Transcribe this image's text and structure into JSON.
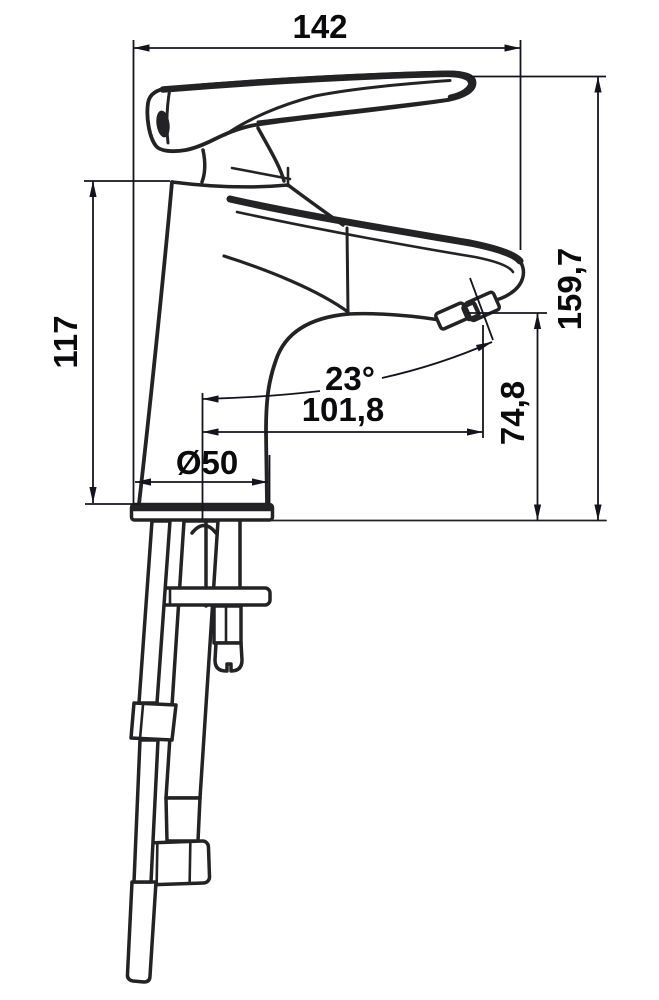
{
  "figure": {
    "type": "technical dimension drawing",
    "subject": "single-lever basin mixer faucet, side view with mounting hardware"
  },
  "labels": {
    "top_width": "142",
    "total_height": "159,7",
    "body_height": "117",
    "outlet_height": "74,8",
    "spout_reach": "101,8",
    "spout_angle": "23°",
    "base_diameter": "Ø50"
  },
  "colors": {
    "drawing_line": "#232326",
    "dimension_line": "#14141f",
    "text": "#0b0b0e",
    "background": "#ffffff"
  }
}
